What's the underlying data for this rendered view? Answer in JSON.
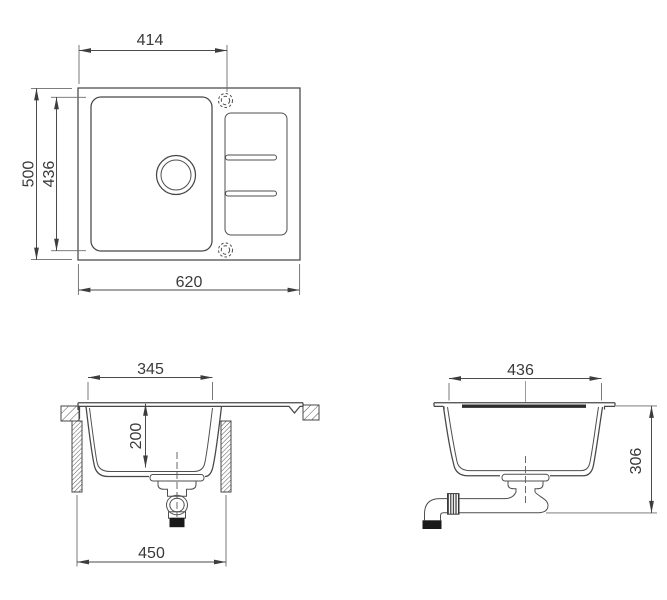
{
  "drawing": {
    "subject": "kitchen sink installation drawing",
    "colors": {
      "background": "#ffffff",
      "line": "#474747",
      "text": "#3a3a3a",
      "dark_fill": "#1a1a1a"
    },
    "views": {
      "top": {
        "label": "top view",
        "dim_tap_offset": "414",
        "dim_overall_depth": "500",
        "dim_bowl_depth": "436",
        "dim_overall_width": "620"
      },
      "front": {
        "label": "front cross-section",
        "dim_bowl_top_width": "345",
        "dim_bowl_inner_depth": "200",
        "dim_base_cabinet_width": "450"
      },
      "side": {
        "label": "side cross-section",
        "dim_bowl_length": "436",
        "dim_clearance_height": "306"
      }
    }
  }
}
